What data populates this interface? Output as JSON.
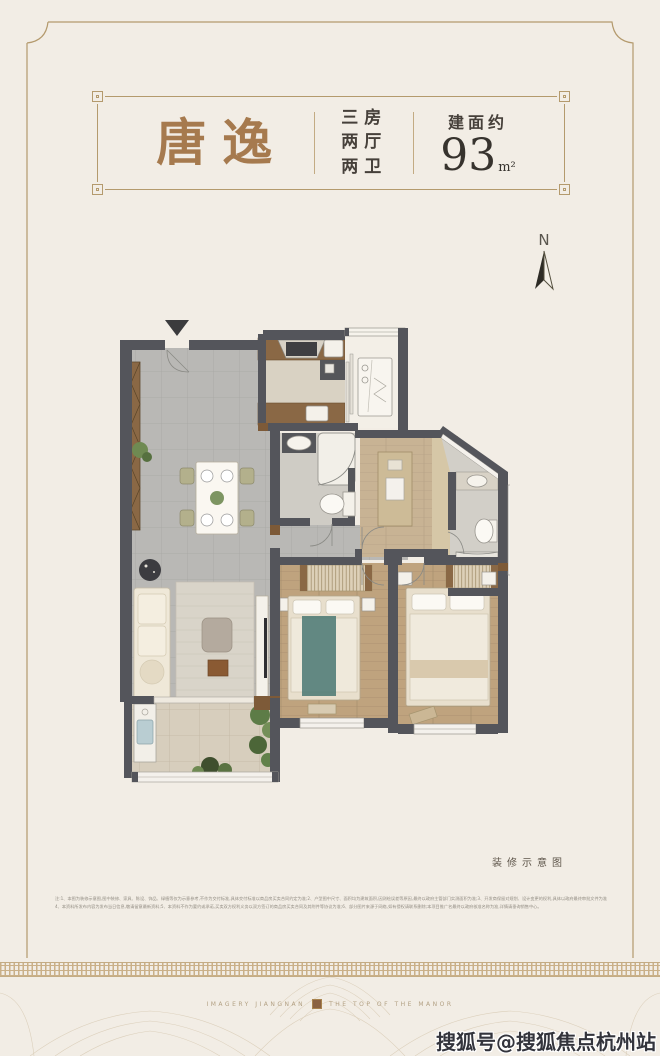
{
  "header": {
    "name": "唐逸",
    "layout_lines": [
      "三房",
      "两厅",
      "两卫"
    ],
    "area_prefix": "建面约",
    "area_value": "93",
    "area_unit": "m²"
  },
  "compass": {
    "label": "N"
  },
  "floorplan": {
    "caption": "装修示意图"
  },
  "disclaimer": {
    "line1": "注:1、本图为装修示意图,图中装修、家具、陈设、饰品、绿植等仅为示意参考,不作为交付标准,具体交付标准以商品房买卖合同约定为准;2、户型图中尺寸、面积均为建筑面积,因测绘误差等原因,最终以政府主管部门实测面积为准;3、开发商保留对规划、设计变更的权利,具体以政府最终审批文件为准;",
    "line2": "4、本资料所发布内容为发布当日信息,敬请留意最新资料;5、本资料不作为要约或承诺,买卖双方权利义务以双方签订的商品房买卖合同及其附件等协议为准;6、部分图片来源于网络,如有侵权请联系删除;本项目推广名最终以政府核准名称为准,详情请垂询销售中心。"
  },
  "footer": {
    "left_text": "IMAGERY JIANGNAN",
    "right_text": "THE TOP OF THE MANOR"
  },
  "watermark": {
    "text": "搜狐号@搜狐焦点杭州站"
  },
  "palette": {
    "background": "#f2ede5",
    "frame": "#b49a6d",
    "title_brown": "#a67a4e",
    "text_dark": "#46403a",
    "wall": "#54555b",
    "wood_door_accent": "#7d5a38",
    "floor_tile": "#b9b8b5",
    "floor_wood": "#bfa17c",
    "floor_balcony": "#d7cebd",
    "furniture_brown": "#8a6845",
    "bed_accent_teal": "#527d78",
    "plant_green": "#6f8a52",
    "watermark_dark": "#33343c"
  }
}
